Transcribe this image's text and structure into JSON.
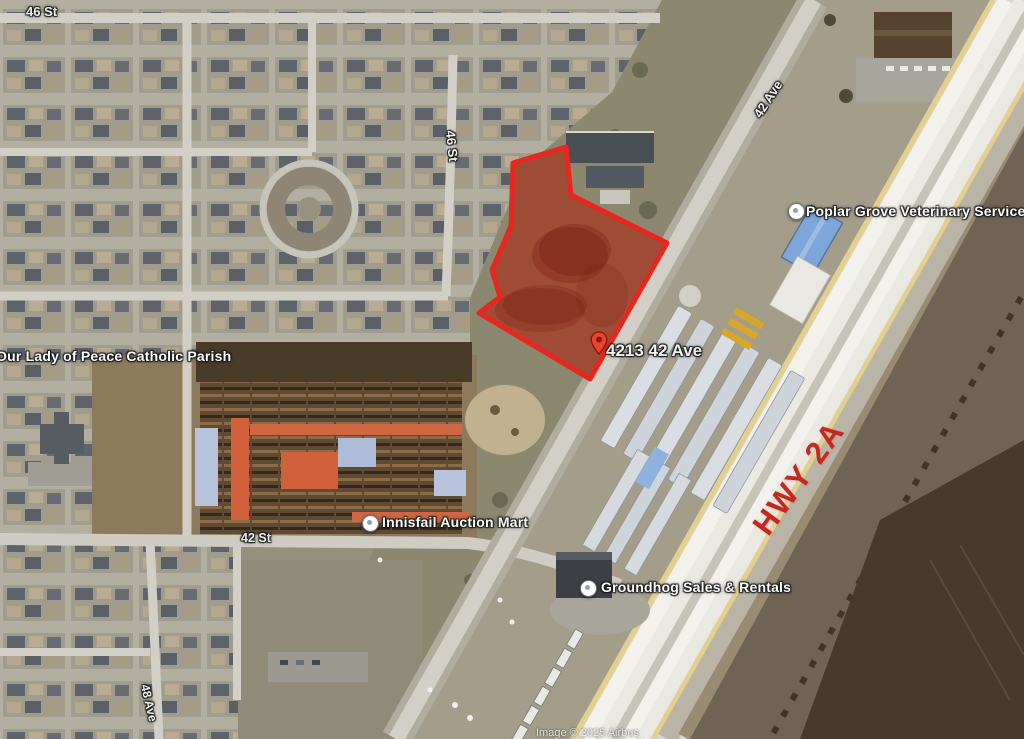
{
  "map": {
    "street_labels": {
      "st_46_top": "46 St",
      "st_46_vertical": "46 St",
      "ave_42": "42 Ave",
      "st_42": "42 St",
      "ave_48": "48 Ave"
    },
    "highway": {
      "label": "HWY 2A",
      "color": "#c5281c"
    },
    "parcel": {
      "address": "4213 42 Ave",
      "outline_color": "#e8261d",
      "fill_color": "rgba(185,35,25,0.45)"
    },
    "pois": [
      {
        "name": "Poplar Grove Veterinary Services"
      },
      {
        "name": "Our Lady of Peace Catholic Parish"
      },
      {
        "name": "Innisfail Auction Mart"
      },
      {
        "name": "Groundhog Sales & Rentals"
      }
    ],
    "attribution": "Image © 2025 Airbus"
  }
}
